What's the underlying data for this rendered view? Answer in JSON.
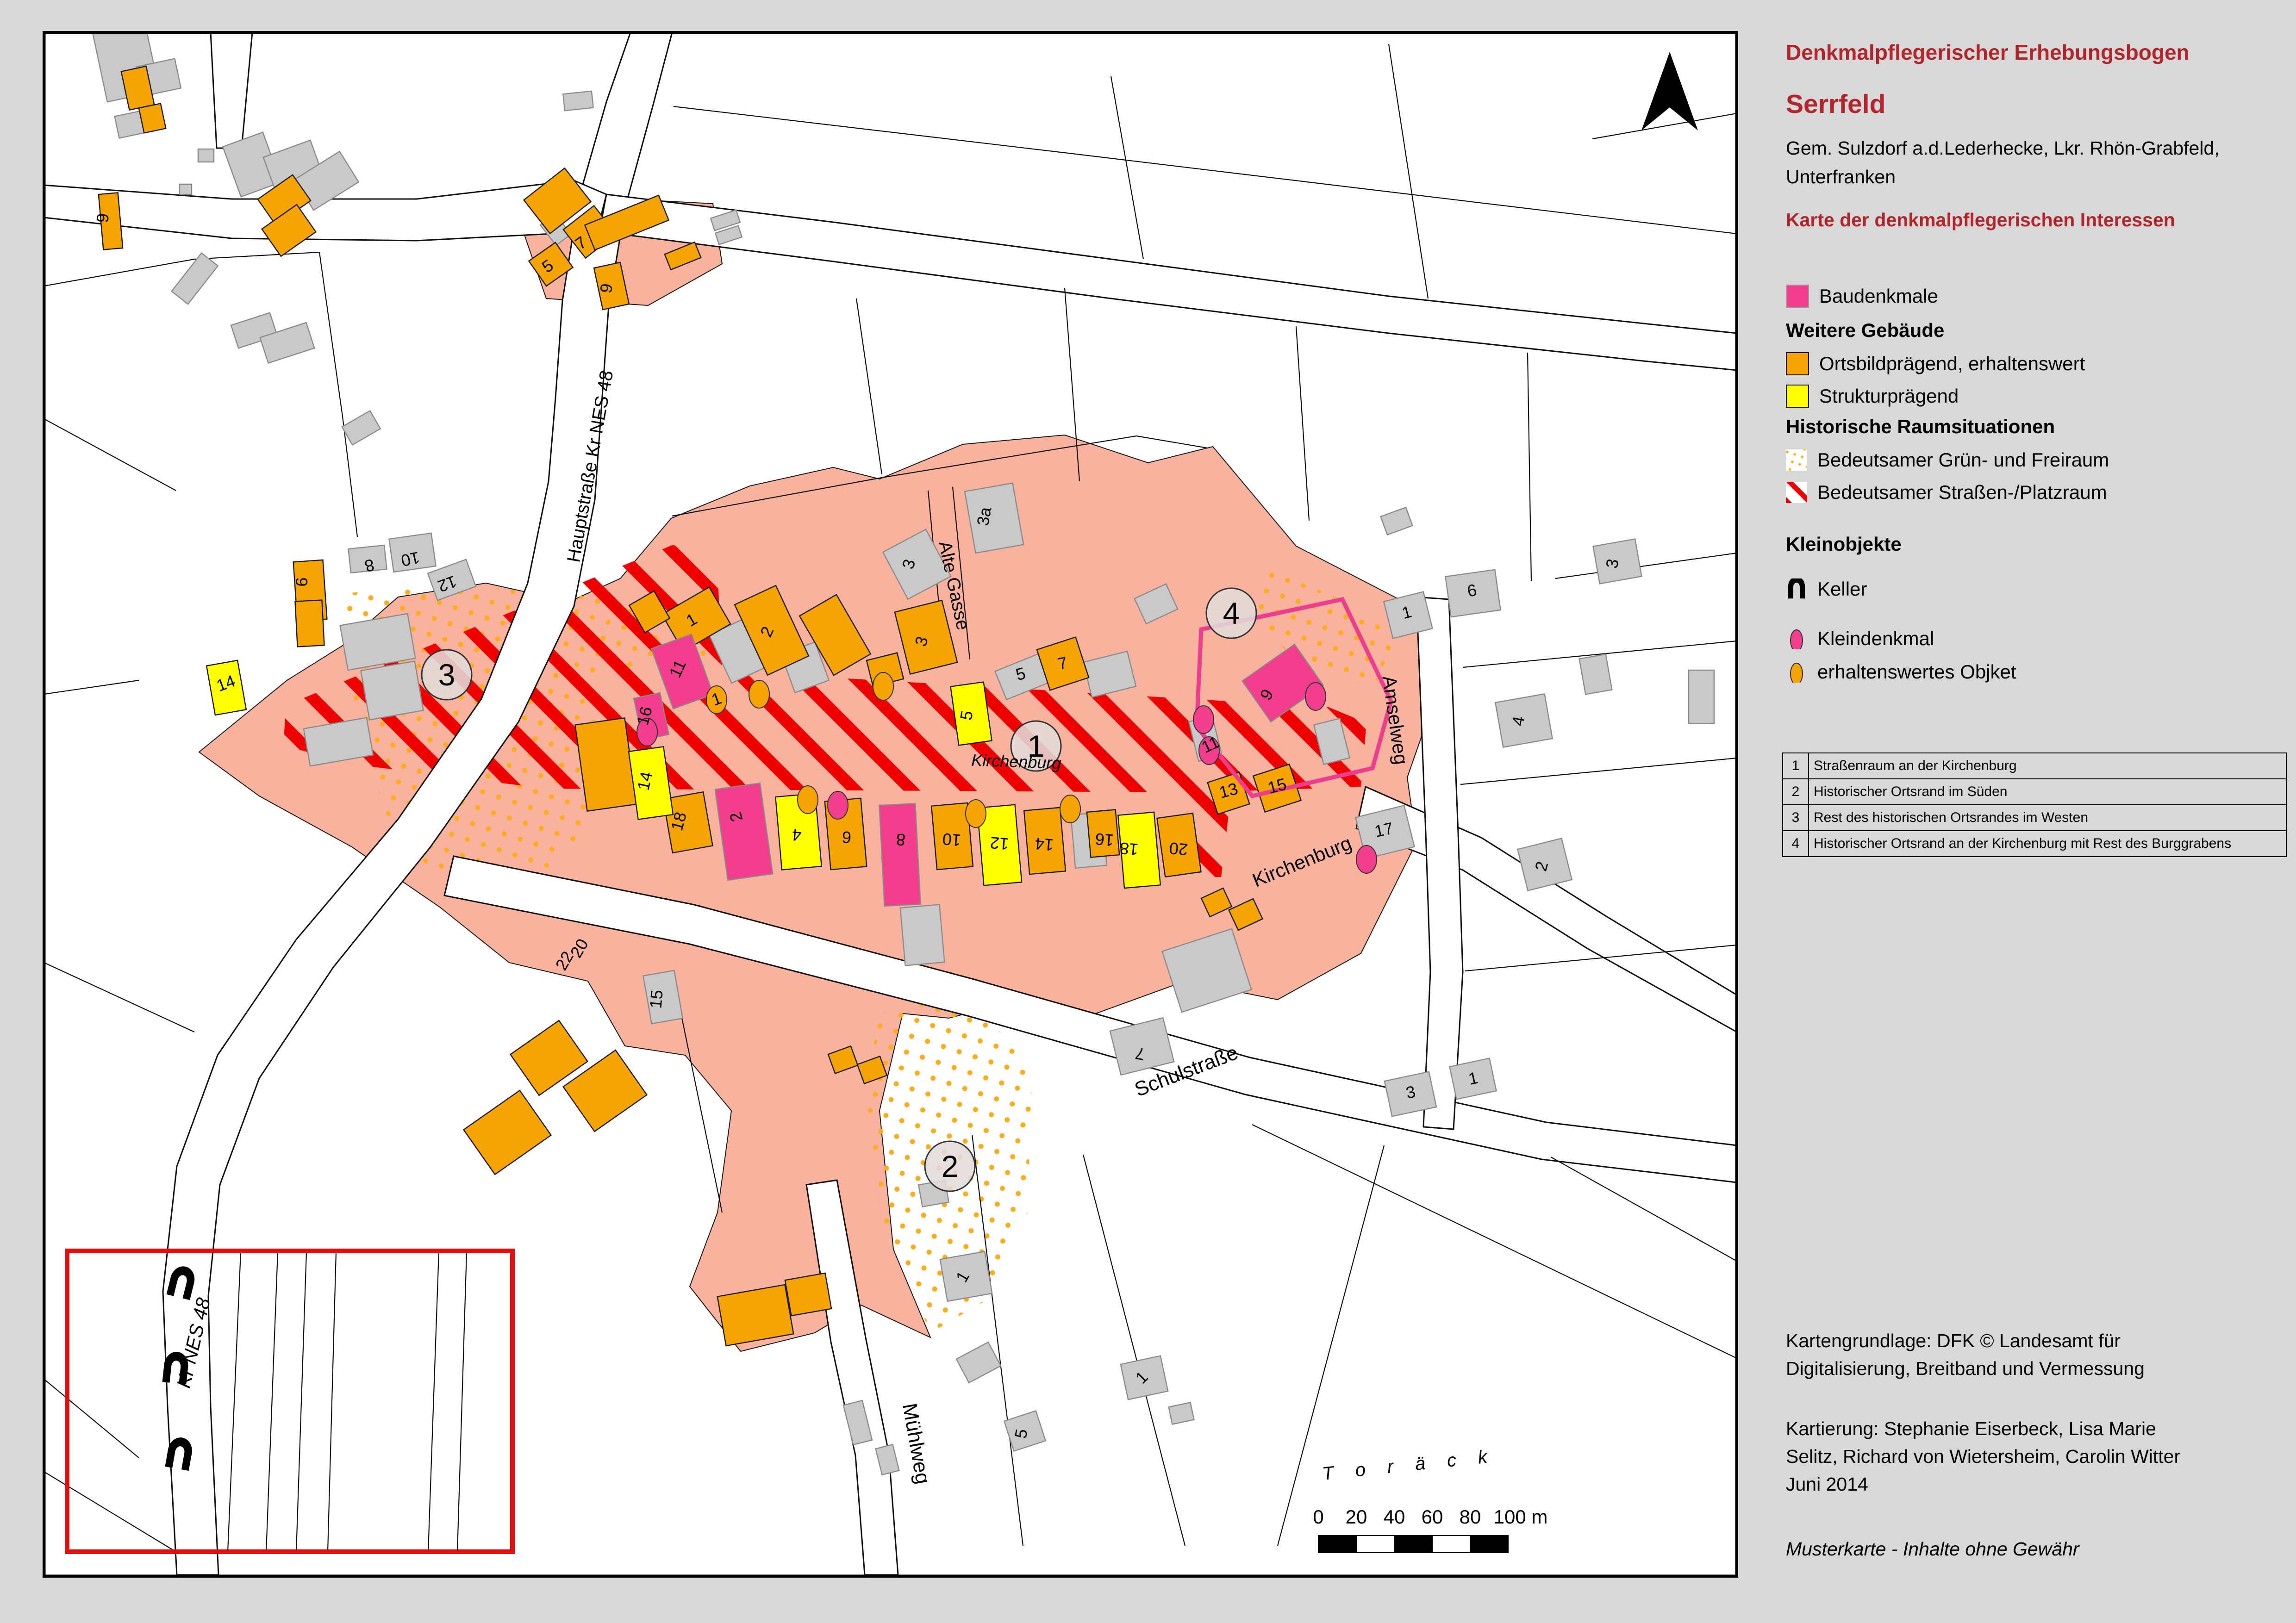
{
  "header": {
    "doc_type": "Denkmalpflegerischer Erhebungsbogen",
    "place": "Serrfeld",
    "subtitle": "Gem. Sulzdorf a.d.Lederhecke, Lkr. Rhön-Grabfeld, Unterfranken",
    "map_title": "Karte der denkmalpflegerischen Interessen"
  },
  "legend": {
    "baudenkmale": "Baudenkmale",
    "weitere_gebaeude": "Weitere Gebäude",
    "ortsbild": "Ortsbildprägend, erhaltenswert",
    "struktur": "Strukturprägend",
    "raumsituationen": "Historische Raumsituationen",
    "gruen": "Bedeutsamer Grün- und Freiraum",
    "strassenraum": "Bedeutsamer Straßen-/Platzraum",
    "kleinobjekte": "Kleinobjekte",
    "keller": "Keller",
    "kleindenkmal": "Kleindenkmal",
    "erhaltenswert": "erhaltenswertes Objket"
  },
  "colors": {
    "title_red": "#B0262C",
    "baudenkmal_pink": "#F23E8C",
    "ortsbild_orange": "#F6A304",
    "struktur_yellow": "#FFFF00",
    "platzraum_red": "#EE0000",
    "gruenraum_dot_orange": "#FFAD1F",
    "village_salmon": "#F8B29E",
    "building_gray": "#C9C9C9"
  },
  "table": {
    "rows": [
      {
        "num": "1",
        "text": "Straßenraum an der Kirchenburg"
      },
      {
        "num": "2",
        "text": "Historischer Ortsrand im Süden"
      },
      {
        "num": "3",
        "text": "Rest des historischen Ortsrandes im Westen"
      },
      {
        "num": "4",
        "text": "Historischer Ortsrand an der Kirchenburg mit Rest des Burggrabens"
      }
    ]
  },
  "credits": {
    "line1": "Kartengrundlage: DFK © Landesamt für",
    "line2": "Digitalisierung, Breitband und Vermessung",
    "line3": "Kartierung: Stephanie Eiserbeck, Lisa Marie",
    "line4": "Selitz, Richard von Wietersheim, Carolin Witter",
    "line5": "Juni 2014",
    "disclaimer": "Musterkarte - Inhalte ohne Gewähr"
  },
  "map": {
    "areas": [
      "1",
      "2",
      "3",
      "4"
    ],
    "scale": {
      "ticks": [
        "0",
        "20",
        "40",
        "60",
        "80",
        "100 m"
      ]
    },
    "field_name": "T   o   r   ä   c   k",
    "streets": [
      {
        "label": "Hauptstraße Kr NES 48"
      },
      {
        "label": "Alte Gasse"
      },
      {
        "label": "Kirchenburg"
      },
      {
        "label": "Kirchenburg"
      },
      {
        "label": "Amselweg"
      },
      {
        "label": "Schulstraße"
      },
      {
        "label": "Mühlweg"
      },
      {
        "label": "Kr NES 48"
      }
    ],
    "hn": [
      "5",
      "7",
      "9",
      "1",
      "2",
      "3",
      "3a",
      "3",
      "5",
      "5",
      "7",
      "1",
      "6",
      "8",
      "10",
      "12",
      "14",
      "11",
      "16",
      "18",
      "2",
      "4",
      "6",
      "8",
      "10",
      "12",
      "14",
      "16",
      "18",
      "20",
      "9",
      "11",
      "13",
      "15",
      "20",
      "22",
      "15",
      "1",
      "6",
      "4",
      "17",
      "2",
      "3",
      "7",
      "1",
      "5",
      "3",
      "1",
      "1",
      "9",
      "14"
    ]
  }
}
